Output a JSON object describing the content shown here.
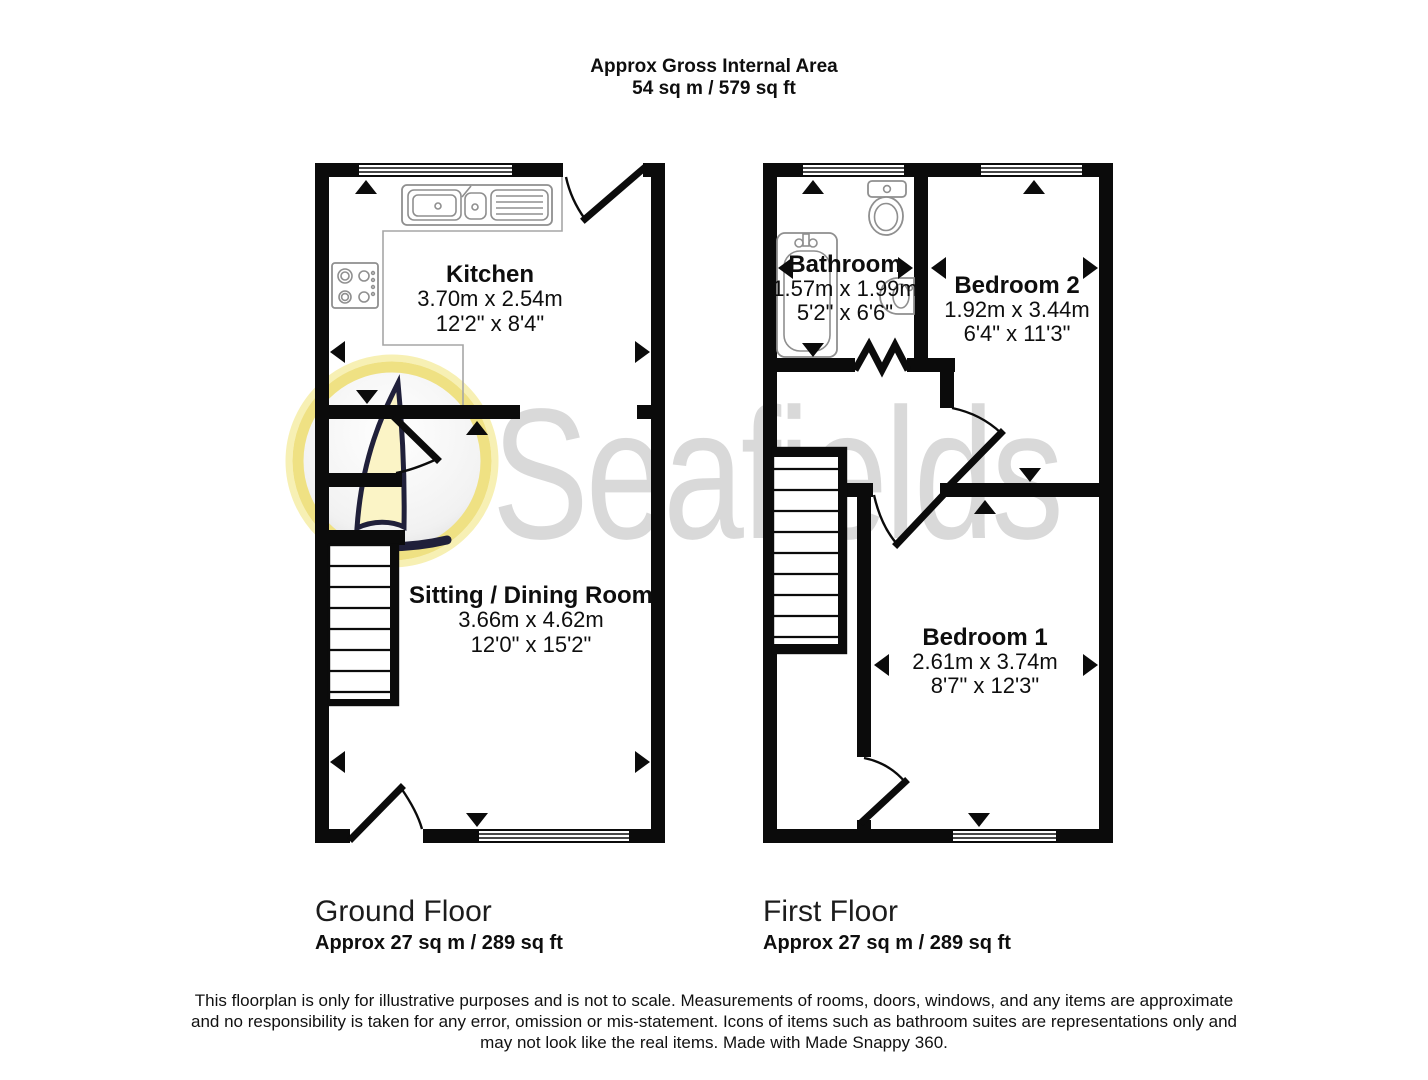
{
  "header": {
    "line1": "Approx Gross Internal Area",
    "line2": "54 sq m / 579 sq ft"
  },
  "watermark": {
    "brand": "Seafields"
  },
  "ground_floor": {
    "label": "Ground Floor",
    "area": "Approx 27 sq m / 289 sq ft",
    "rooms": {
      "kitchen": {
        "name": "Kitchen",
        "metric": "3.70m x 2.54m",
        "imperial": "12'2\" x 8'4\""
      },
      "sitting": {
        "name": "Sitting / Dining Room",
        "metric": "3.66m x 4.62m",
        "imperial": "12'0\" x 15'2\""
      }
    }
  },
  "first_floor": {
    "label": "First Floor",
    "area": "Approx 27 sq m / 289 sq ft",
    "rooms": {
      "bathroom": {
        "name": "Bathroom",
        "metric": "1.57m x 1.99m",
        "imperial": "5'2\" x 6'6\""
      },
      "bedroom2": {
        "name": "Bedroom 2",
        "metric": "1.92m x 3.44m",
        "imperial": "6'4\" x 11'3\""
      },
      "bedroom1": {
        "name": "Bedroom 1",
        "metric": "2.61m x 3.74m",
        "imperial": "8'7\" x 12'3\""
      }
    }
  },
  "disclaimer": {
    "line1": "This floorplan is only for illustrative purposes and is not to scale. Measurements of rooms, doors, windows, and any items are approximate",
    "line2": "and no responsibility is taken for any error, omission or mis-statement. Icons of items such as bathroom suites are representations only and",
    "line3": "may not look like the real items. Made with Made Snappy 360."
  },
  "colors": {
    "wall": "#0b0b0b",
    "fixture_outline": "#8f8f8f",
    "watermark_text": "#d9d9d9",
    "logo_ring": "#eedf7a",
    "logo_sail": "#fbf4c6"
  }
}
